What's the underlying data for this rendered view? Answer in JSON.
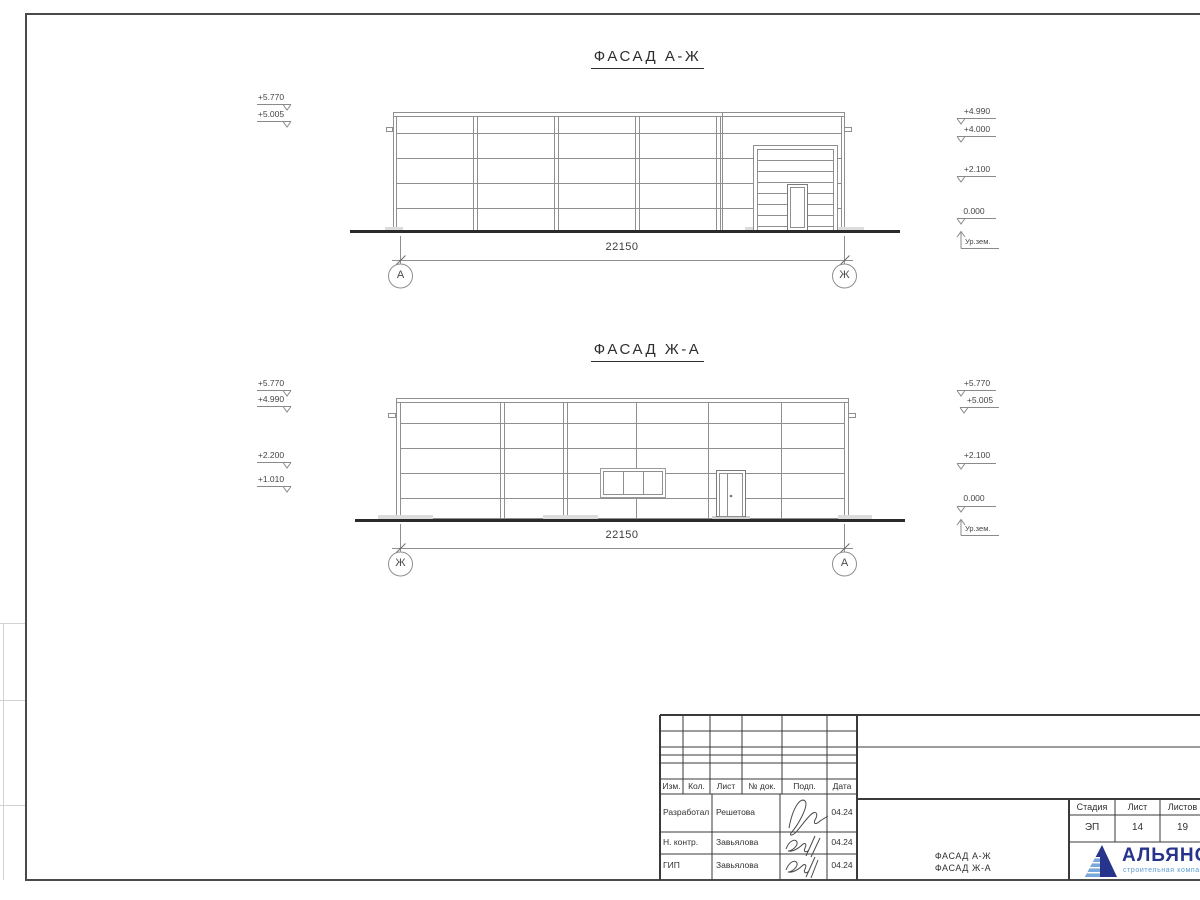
{
  "sheet": {
    "facades": [
      {
        "title": "ФАСАД А-Ж",
        "dimension": "22150",
        "axis_left": "А",
        "axis_right": "Ж",
        "marks_left": [
          "+5.770",
          "+5.005"
        ],
        "marks_right": [
          "+4.990",
          "+4.000",
          "+2.100",
          "0.000"
        ],
        "ground_label": "Ур.зем."
      },
      {
        "title": "ФАСАД Ж-А",
        "dimension": "22150",
        "axis_left": "Ж",
        "axis_right": "А",
        "marks_left": [
          "+5.770",
          "+4.990",
          "+2.200",
          "+1.010"
        ],
        "marks_right": [
          "+5.770",
          "+5.005",
          "+2.100",
          "0.000"
        ],
        "ground_label": "Ур.зем."
      }
    ]
  },
  "titleblock": {
    "columns": [
      "Изм.",
      "Кол.",
      "Лист",
      "№ док.",
      "Подп.",
      "Дата"
    ],
    "rows": [
      {
        "role": "Разработал",
        "name": "Решетова",
        "date": "04.24"
      },
      {
        "role": "Н. контр.",
        "name": "Завьялова",
        "date": "04.24"
      },
      {
        "role": "ГИП",
        "name": "Завьялова",
        "date": "04.24"
      }
    ],
    "drawing_name": [
      "ФАСАД А-Ж",
      "ФАСАД Ж-А"
    ],
    "stage_label": "Стадия",
    "sheet_label": "Лист",
    "sheets_label": "Листов",
    "stage": "ЭП",
    "sheet_no": "14",
    "sheets_total": "19",
    "logo": {
      "name": "АЛЬЯНС",
      "subtitle": "строительная компания"
    }
  },
  "colors": {
    "frame": "#4a4a4a",
    "drawing_lines": "#8f8f8f",
    "ground_line": "#2b2b2b",
    "table_lines": "#3a3a3a",
    "logo_navy": "#27348b",
    "logo_blue": "#5b9bd5"
  }
}
